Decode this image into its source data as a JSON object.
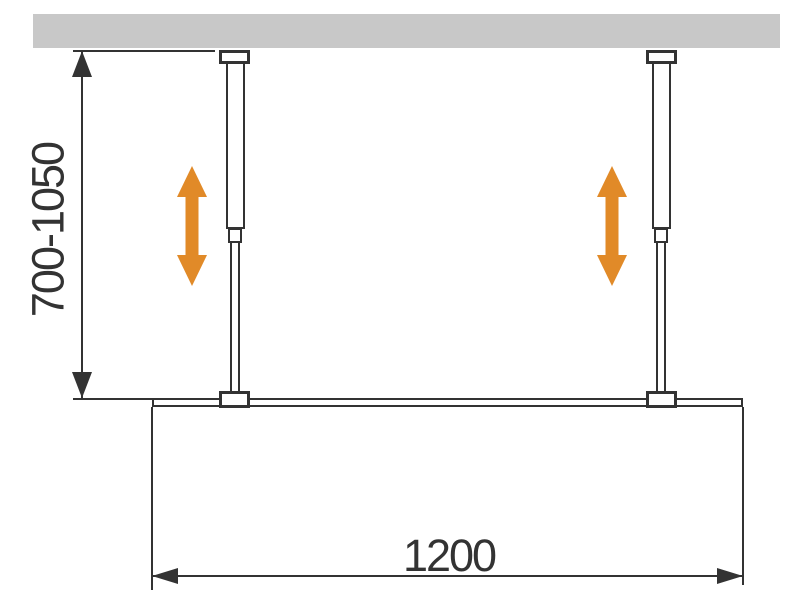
{
  "diagram_type": "technical installation drawing (plan view) of a walk-in glass screen with two adjustable ceiling/wall support bars",
  "dimensions": {
    "support_bar_length": {
      "label": "700-1050",
      "orientation": "vertical"
    },
    "panel_width": {
      "label": "1200",
      "orientation": "horizontal"
    }
  },
  "colors": {
    "background": "#ffffff",
    "wall_fill": "#c8c8c8",
    "line": "#333333",
    "adjust_arrow": "#e18a28"
  },
  "icons": {
    "height_adjust_arrow": "double-headed vertical arrow ↕",
    "dimension_arrowheads": "solid triangle"
  }
}
